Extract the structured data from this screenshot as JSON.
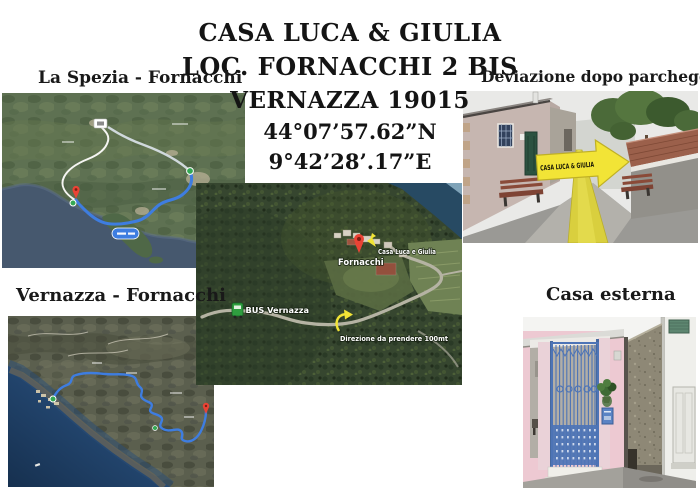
{
  "title_block": {
    "line1": "CASA LUCA & GIULIA",
    "line2": "LOC. FORNACCHI 2 BIS",
    "line3": "VERNAZZA 19015",
    "line4": "44°07’57.62”N",
    "line5": "9°42’28’.17”E"
  },
  "captions": {
    "la_spezia_map": "La Spezia - Fornacchi",
    "deviazione_photo": "Deviazione dopo parcheggio",
    "vernazza_map": "Vernazza - Fornacchi",
    "casa_esterna_photo": "Casa esterna"
  },
  "deviazione_photo": {
    "arrow_text": "CASA LUCA & GIULIA"
  },
  "aerial_photo": {
    "pin_label": "Fornacchi",
    "house_label": "Casa Luca e Giulia",
    "bus_label": "BUS Vernazza",
    "direction_label": "Direzione da prendere 100mt"
  },
  "colors": {
    "title-ink": "#141414",
    "route-blue": "#3e7de0",
    "pin-red": "#ea4335",
    "marker-green": "#34a853",
    "arrow-yellow": "#f2e436",
    "path-yellow": "#d9cf3e",
    "sea-slate": "#46586e",
    "sea-deep": "#1c3c66",
    "aerial-sea": "#274a63",
    "forest-dark": "#36462f",
    "terrain-green": "#5e7152",
    "house-pink": "#edc9d2",
    "gate-blue": "#4d74b6",
    "roof-tile": "#9b604b"
  }
}
